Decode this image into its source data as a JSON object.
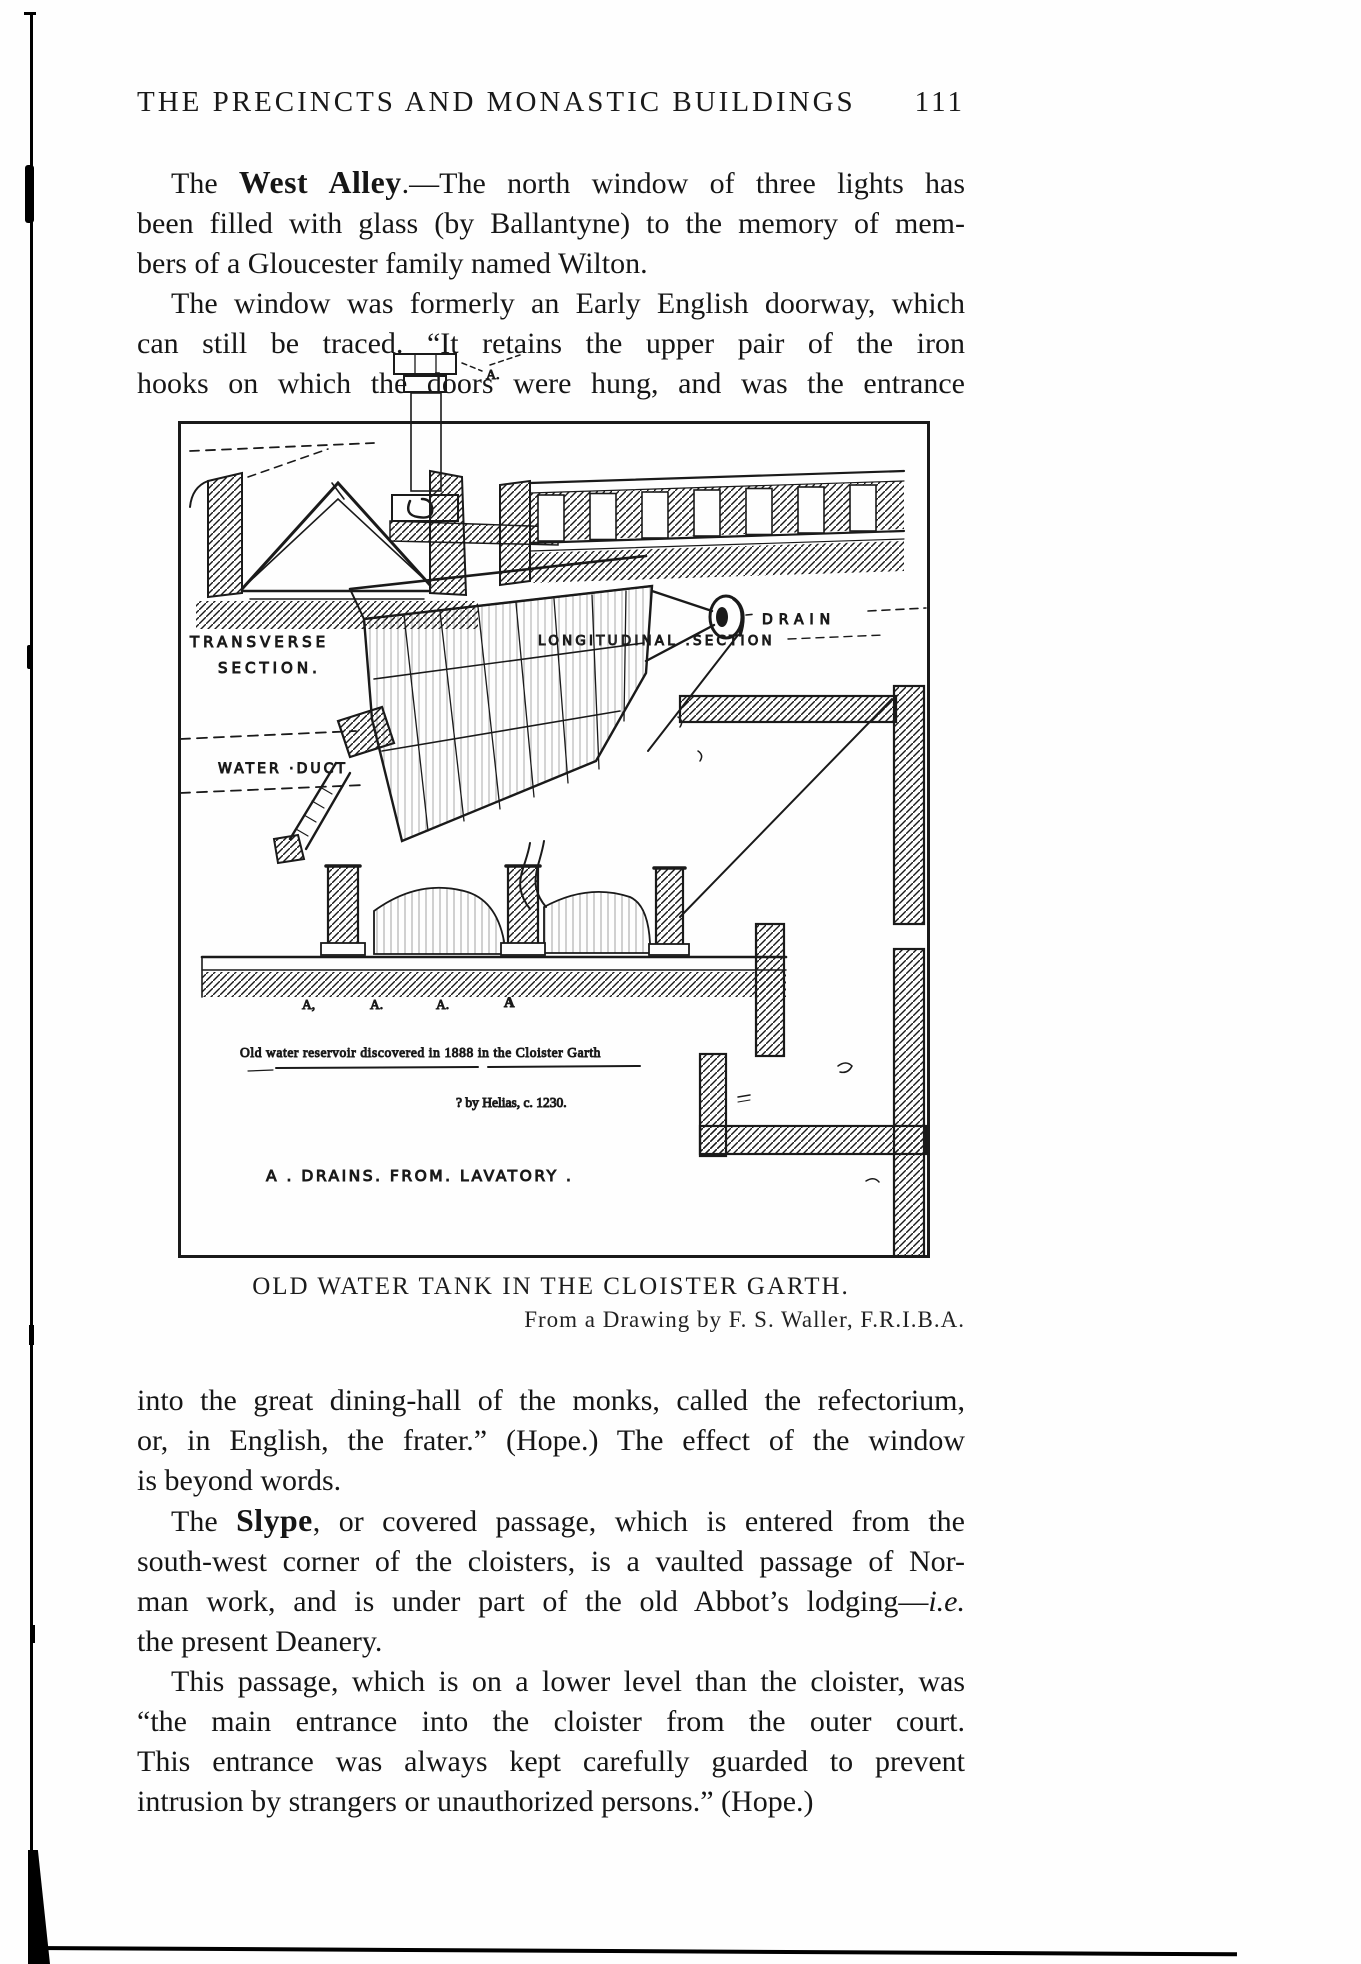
{
  "page": {
    "header": {
      "title": "THE PRECINCTS AND MONASTIC BUILDINGS",
      "page_number": "111"
    },
    "paragraphs_top": [
      {
        "indent": true,
        "justify_last": false,
        "lines": [
          [
            {
              "t": "The "
            },
            {
              "t": "West Alley",
              "b": true
            },
            {
              "t": ".—The north window of three lights has"
            }
          ],
          [
            {
              "t": "been filled with glass (by Ballantyne) to the memory of mem-"
            }
          ],
          [
            {
              "t": "bers of a Gloucester family named Wilton."
            }
          ]
        ]
      },
      {
        "indent": true,
        "justify_last": true,
        "lines": [
          [
            {
              "t": "The window was formerly an Early English doorway, which"
            }
          ],
          [
            {
              "t": "can still be traced.  “It retains the upper pair of the iron"
            }
          ],
          [
            {
              "t": "hooks on which the doors were hung, and was the entrance"
            }
          ]
        ]
      }
    ],
    "figure": {
      "caption": "OLD WATER TANK IN THE CLOISTER GARTH.",
      "credit": "From a Drawing by F. S. Waller, F.R.I.B.A.",
      "labels": {
        "transverse_1": "TRANSVERSE",
        "transverse_2": "SECTION.",
        "longitudinal": "LONGITUDINAL .SECTION",
        "water_duct": "WATER ·DUCT",
        "drain": "DRAIN",
        "marker_a_top": "A.",
        "marker_row_1": "A,",
        "marker_row_2": "A.",
        "marker_row_3": "A.",
        "marker_row_4": "A",
        "inscription_line1": "Old water reservoir discovered in 1888 in the Cloister Garth",
        "inscription_line2": "? by Helias, c. 1230.",
        "inscription_line3": "A . DRAINS. FROM. LAVATORY ."
      }
    },
    "paragraphs_bottom": [
      {
        "indent": false,
        "justify_last": false,
        "lines": [
          [
            {
              "t": "into the great dining-hall of the monks, called the refectorium,"
            }
          ],
          [
            {
              "t": "or, in English, the frater.”  (Hope.)  The effect of the window"
            }
          ],
          [
            {
              "t": "is beyond words."
            }
          ]
        ]
      },
      {
        "indent": true,
        "justify_last": false,
        "lines": [
          [
            {
              "t": "The "
            },
            {
              "t": "Slype",
              "b": true
            },
            {
              "t": ", or covered passage, which is entered from the"
            }
          ],
          [
            {
              "t": "south-west corner of the cloisters, is a vaulted passage of Nor-"
            }
          ],
          [
            {
              "t": "man work, and is under part of the old Abbot’s lodging—"
            },
            {
              "t": "i.e.",
              "i": true
            }
          ],
          [
            {
              "t": "the present Deanery."
            }
          ]
        ]
      },
      {
        "indent": true,
        "justify_last": false,
        "lines": [
          [
            {
              "t": "This passage, which is on a lower level than the cloister, was"
            }
          ],
          [
            {
              "t": "“the main entrance into the cloister from the outer court."
            }
          ],
          [
            {
              "t": "This entrance was always kept carefully guarded to prevent"
            }
          ],
          [
            {
              "t": "intrusion by strangers or unauthorized persons.”  (Hope.)"
            }
          ]
        ]
      }
    ]
  }
}
